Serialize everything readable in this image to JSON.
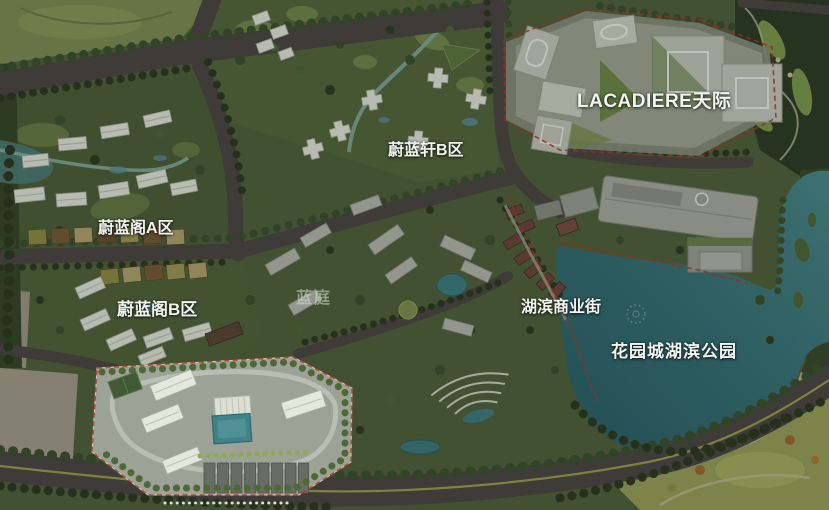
{
  "map": {
    "type": "aerial-masterplan-rendering",
    "labels": [
      {
        "id": "lacadiere-tianji",
        "text": "LACADIERE天际"
      },
      {
        "id": "weilanxuan-zone-b",
        "text": "蔚蓝轩B区"
      },
      {
        "id": "weilange-zone-a",
        "text": "蔚蓝阁A区"
      },
      {
        "id": "weilange-zone-b",
        "text": "蔚蓝阁B区"
      },
      {
        "id": "lakeside-commercial-street",
        "text": "湖滨商业街"
      },
      {
        "id": "garden-city-lakeside-park",
        "text": "花园城湖滨公园"
      },
      {
        "id": "lanting-watermark",
        "text": "蓝庭"
      }
    ],
    "colors": {
      "label_text": "#f4f5f1",
      "lake_water_light": "#4b8a8c",
      "lake_water_dark": "#2a5f66",
      "road_asphalt": "#4b4744",
      "highway_median": "#9aa04a",
      "boundary_dashed_red": "#b23a28",
      "parcel_ground": "#9ca295",
      "building_white": "#e4e7dc",
      "meadow_green": "#7f8f55",
      "forest_green": "#2e3c26",
      "bare_field_tan": "#a69d8d",
      "commercial_roof_brown": "#6e463c"
    }
  }
}
